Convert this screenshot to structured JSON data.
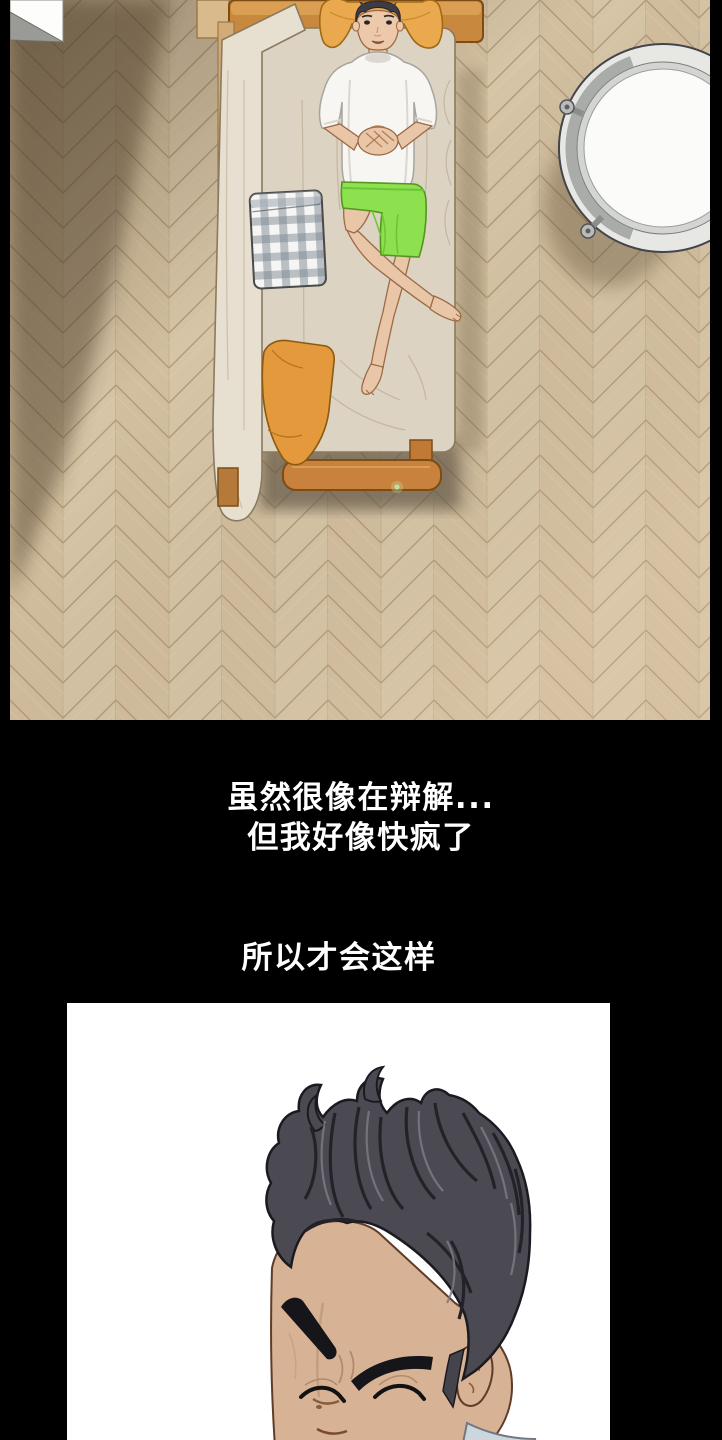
{
  "page": {
    "kind": "webtoon comic strip page",
    "background": "#000000",
    "width": 722,
    "height": 1440
  },
  "captions": {
    "color": "#ffffff",
    "lines": [
      {
        "text": "虽然很像在辩解..."
      },
      {
        "text": "但我好像快疯了"
      },
      {
        "text": "所以才会这样"
      }
    ]
  },
  "panels": {
    "top_scene": {
      "description": "overhead view of a young man lying on a narrow single bed, hands clasped on stomach, legs crossed, on a herringbone parquet floor with a round white side table at upper right",
      "colors": {
        "floor": "#cfbc9e",
        "floor_alt": "#d7c5a7",
        "mattress": "#dcd3c3",
        "blanket": "#e7dfd0",
        "wood_frame": "#c9823d",
        "head_pillow": "#eaa94e",
        "floor_pillow": "#e49a3c",
        "gingham_pillow": "#8d99a4",
        "shirt": "#f7f6f3",
        "shorts": "#8de04e",
        "skin": "#e9c6a8",
        "hair": "#3d3c42",
        "table_top": "#fbfbfa",
        "table_rim": "#b9bcb9"
      }
    },
    "bottom_scene": {
      "description": "close-up of a man with wavy dark swept-back hair, thick eyebrows, eyes closed, head bowed, light collar visible",
      "background": "#ffffff",
      "colors": {
        "hair": "#4b4a52",
        "skin": "#d8b295",
        "collar": "#cdd5dd"
      }
    }
  }
}
